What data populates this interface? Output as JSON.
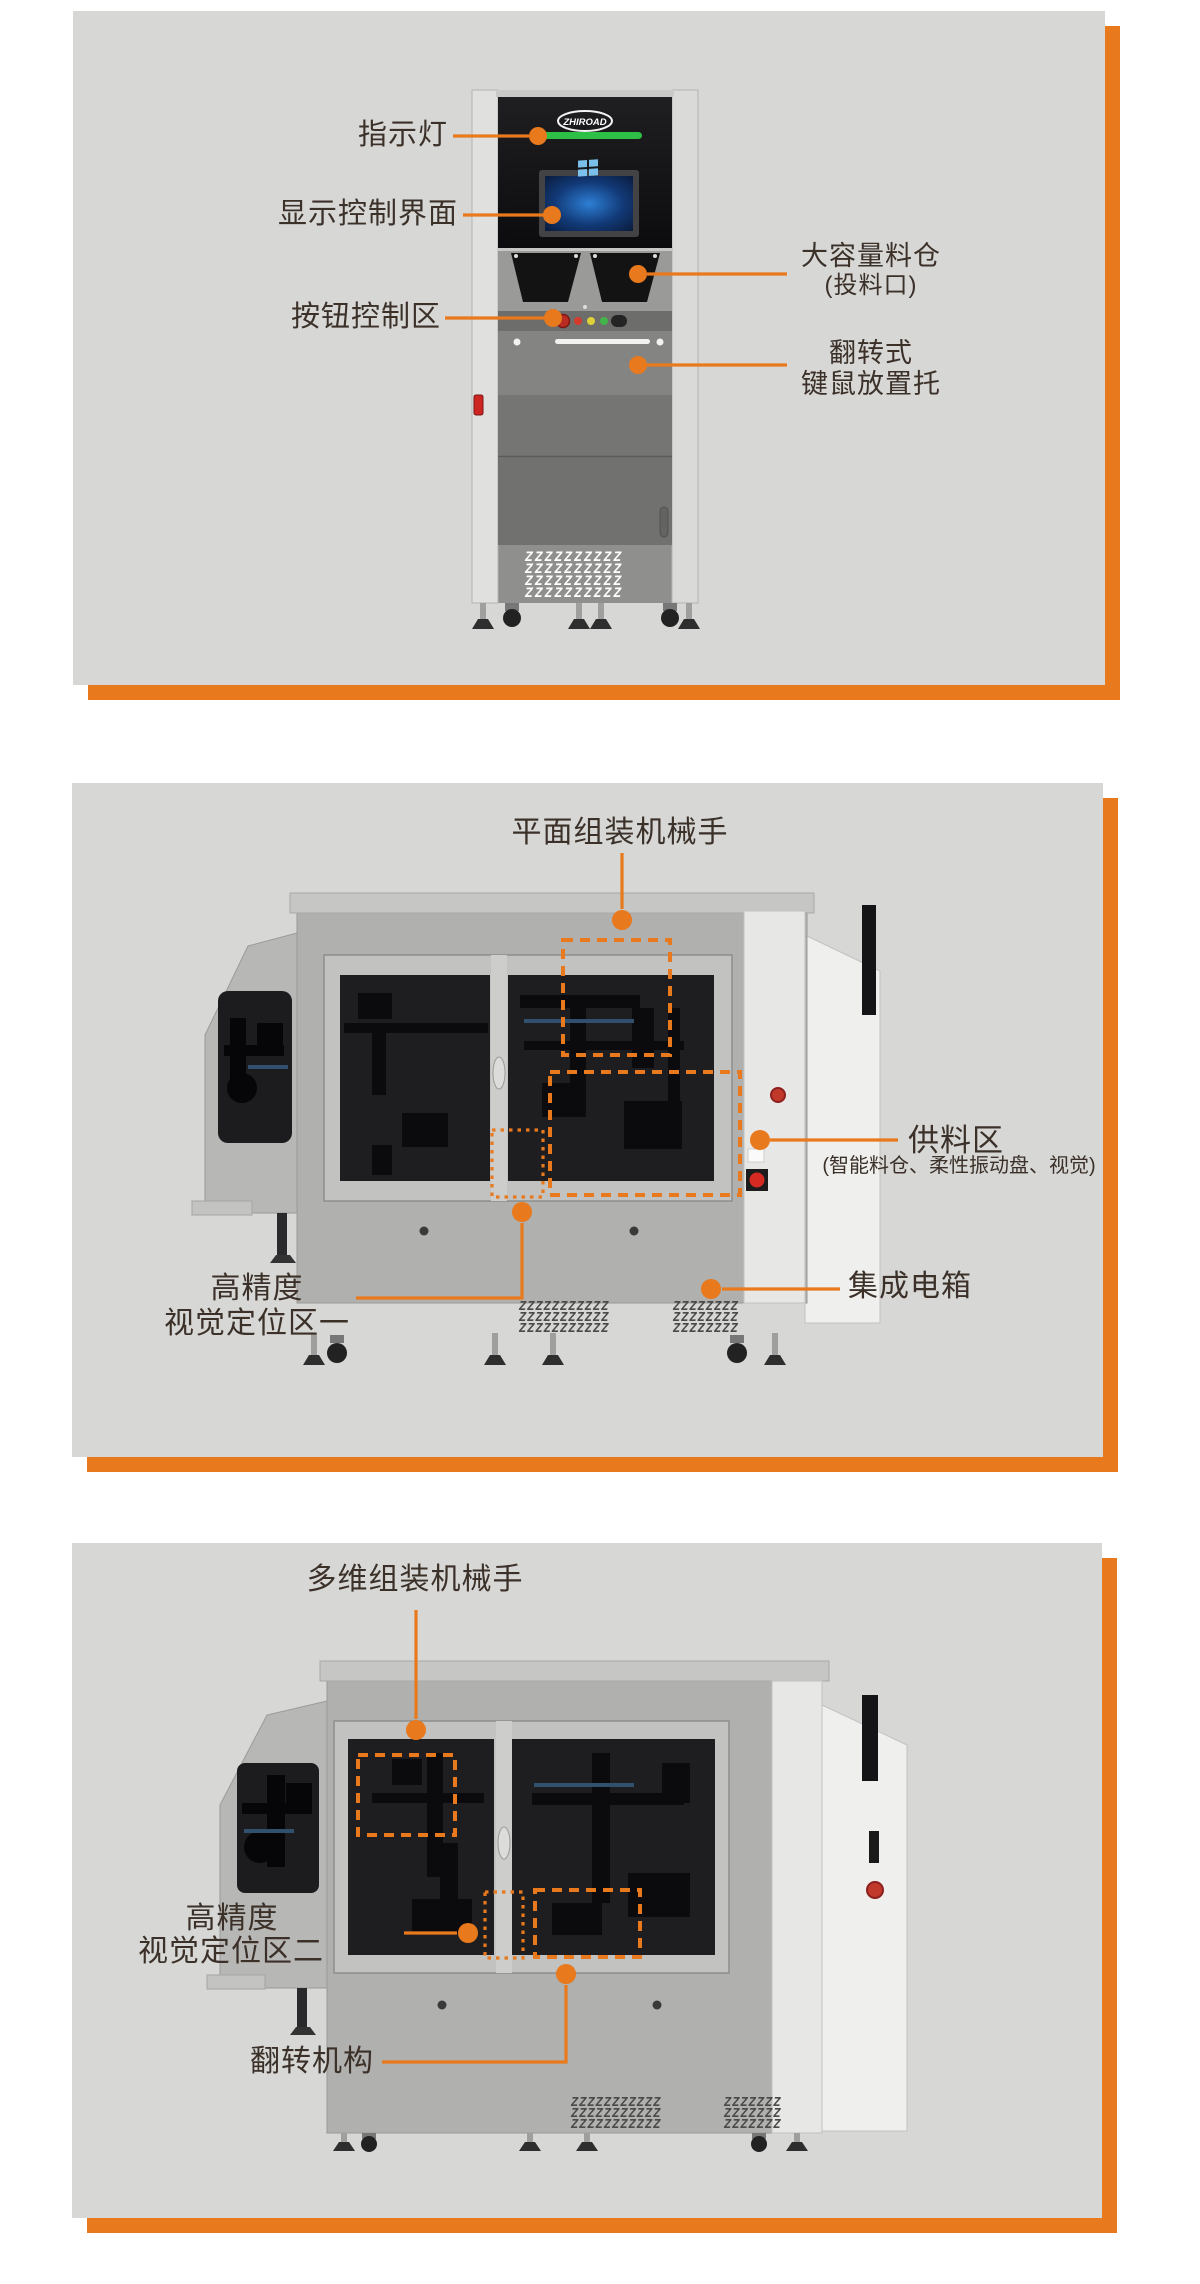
{
  "page": {
    "accent_orange": "#E8791D",
    "panel_gray": "#D7D7D6",
    "label_color": "#3B3129",
    "indicator_green": "#2EBF47"
  },
  "panel1": {
    "view": "front-cabinet-view",
    "machine": {
      "brand": "ZHIROAD"
    },
    "labels": {
      "indicator": "指示灯",
      "display": "显示控制界面",
      "buttons": "按钮控制区",
      "hopper_line1": "大容量料仓",
      "hopper_line2": "(投料口)",
      "tray_line1": "翻转式",
      "tray_line2": "键鼠放置托"
    }
  },
  "panel2": {
    "view": "side-view-planar",
    "labels": {
      "robot": "平面组装机械手",
      "feed_title": "供料区",
      "feed_sub": "(智能料仓、柔性振动盘、视觉)",
      "ebox": "集成电箱",
      "vision_line1": "高精度",
      "vision_line2": "视觉定位区一"
    }
  },
  "panel3": {
    "view": "side-view-multidim",
    "labels": {
      "robot": "多维组装机械手",
      "vision_line1": "高精度",
      "vision_line2": "视觉定位区二",
      "flip": "翻转机构"
    }
  }
}
